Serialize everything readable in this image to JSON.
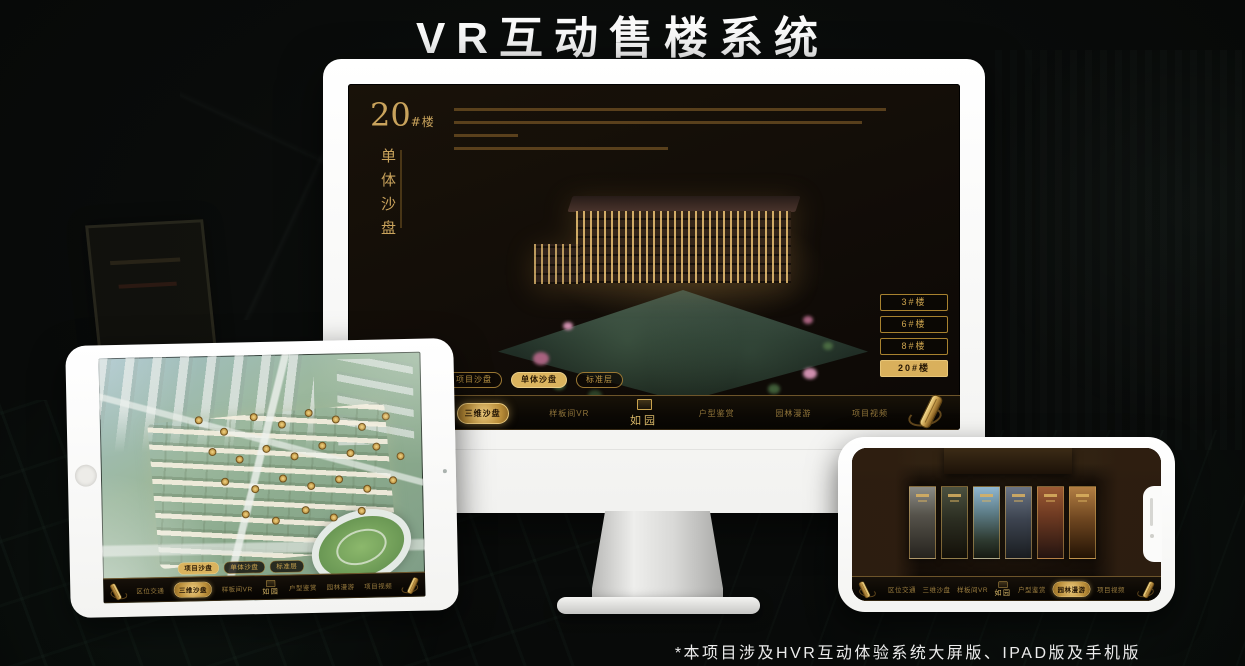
{
  "page": {
    "title": "VR互动售楼系统",
    "footnote": "*本项目涉及HVR互动体验系统大屏版、IPAD版及手机版"
  },
  "colors": {
    "gold": "#CDA44E",
    "gold_fill": "#D9B05C",
    "screen_bg": "#14100A",
    "title_color": "#FAFAFA"
  },
  "monitor_app": {
    "block_number": "20",
    "block_unit": "#楼",
    "block_subtitle": "单体沙盘",
    "floor_buttons": [
      {
        "label": "3#楼",
        "selected": false
      },
      {
        "label": "6#楼",
        "selected": false
      },
      {
        "label": "8#楼",
        "selected": false
      },
      {
        "label": "20#楼",
        "selected": true
      }
    ],
    "view_tabs": [
      {
        "label": "项目沙盘",
        "selected": false
      },
      {
        "label": "单体沙盘",
        "selected": true
      },
      {
        "label": "标准层",
        "selected": false
      }
    ],
    "nav": {
      "logo": "如园",
      "items": [
        {
          "label": "区位交通",
          "selected": false
        },
        {
          "label": "三维沙盘",
          "selected": true
        },
        {
          "label": "样板间VR",
          "selected": false
        },
        {
          "label": "户型鉴赏",
          "selected": false
        },
        {
          "label": "园林漫游",
          "selected": false
        },
        {
          "label": "项目视频",
          "selected": false
        }
      ]
    }
  },
  "tablet_app": {
    "view_tabs": [
      {
        "label": "项目沙盘",
        "selected": true
      },
      {
        "label": "单体沙盘",
        "selected": false
      },
      {
        "label": "标准层",
        "selected": false
      }
    ],
    "nav": {
      "logo": "如园",
      "items": [
        {
          "label": "区位交通",
          "selected": false
        },
        {
          "label": "三维沙盘",
          "selected": true
        },
        {
          "label": "样板间VR",
          "selected": false
        },
        {
          "label": "户型鉴赏",
          "selected": false
        },
        {
          "label": "园林漫游",
          "selected": false
        },
        {
          "label": "项目视频",
          "selected": false
        }
      ]
    }
  },
  "phone_app": {
    "nav": {
      "logo": "如园",
      "items": [
        {
          "label": "区位交通",
          "selected": false
        },
        {
          "label": "三维沙盘",
          "selected": false
        },
        {
          "label": "样板间VR",
          "selected": false
        },
        {
          "label": "户型鉴赏",
          "selected": false
        },
        {
          "label": "园林漫游",
          "selected": true
        },
        {
          "label": "项目视频",
          "selected": false
        }
      ]
    }
  }
}
